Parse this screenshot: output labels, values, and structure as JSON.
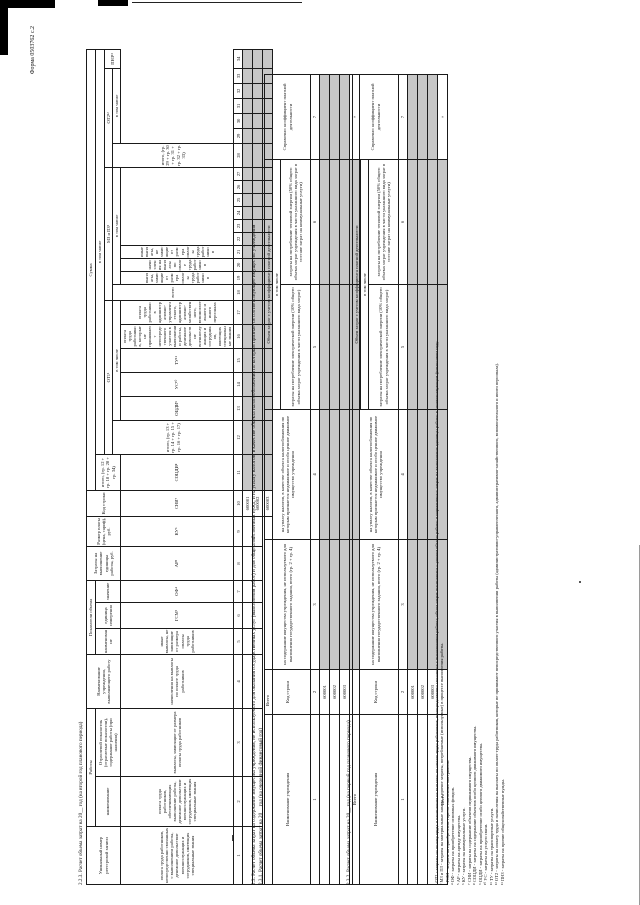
{
  "form_code": "Форма 0503762 с.2",
  "t1": {
    "title": "2.2.3. Расчет объема затрат на 20__ год (на второй год планового периода)",
    "works_group": "Работы",
    "vol_group": "Показатели объема",
    "sum_group": "Сумма",
    "incl": "в том числе",
    "c1": "Уникальный номер реестровой записи",
    "c2": "наименование",
    "c3": "Отраслевой показатель (отраслевые показатели), содержание работы (при наличии)",
    "c4": "Наименование учреждения, выполняющего работу",
    "c5": "наименование",
    "c6": "единица измерения",
    "c7": "значение",
    "c8": "Затраты на выполнение единицы работы, руб.",
    "c9": "Размер платы (цена, тариф), руб.",
    "c10": "Код строки",
    "c11": "итого, (гр. 12 + гр. 18 + гр. 28 + гр. 34)",
    "ot1_group": "ОТ1¹",
    "c12": "итого, (гр. 13 + гр. 14 + гр. 15 + гр. 16 + гр. 17)",
    "c13": "оплата труда работников, непосредственно связанных с выполнением работы, денежное довольствие военнослужащих и сотрудников, имеющих специальные звания",
    "c14": "оплата труда работников, обеспечивающих выполнение работы, денежное довольствие военнослужащих и сотрудников, имеющих специальные звания",
    "c15": "выплаты, зависящие от размера оплаты труда работников",
    "c16": "начисления на выплаты по оплате труда работников",
    "c17": "иные выплаты, не зависящие от размера оплаты труда работников",
    "mz_group": "МЗ и ПЗ²",
    "c18": "всего",
    "c19": "ГСМ³",
    "c20": "ОФ⁴",
    "c21": "АР⁵",
    "c22": "КУ⁶",
    "c23": "СНИ⁷",
    "c24": "СОЦДИ⁸",
    "c25": "ОЦДИ⁹",
    "c26": "УС¹⁰",
    "c27": "ТУ¹¹",
    "ot2_group": "ОТ2¹²",
    "c28": "итого, (гр. 29 + гр. 30 + гр. 31 + гр. 32 + гр. 33)",
    "c29": "оплата труда работников, которые не принимают непосредственного участия в выполнении работы, денежное довольствие военнослужащих и сотрудников, имеющих специальные звания",
    "c30": "оплата труда работников административно-управленческого, административно-хозяйственного, вспомогательного и иного персонала",
    "c31": "выплаты, зависящие от размера оплаты труда работников",
    "c32": "начисления на выплаты по оплате труда работников",
    "c33": "иные выплаты, не зависящие от размера оплаты труда работников",
    "c34": "ПНЗ¹³",
    "col_numbers": [
      "1",
      "2",
      "3",
      "4",
      "5",
      "6",
      "7",
      "8",
      "9",
      "10",
      "11",
      "12",
      "13",
      "14",
      "15",
      "16",
      "17",
      "18",
      "19",
      "20",
      "21",
      "22",
      "23",
      "24",
      "25",
      "26",
      "27",
      "28",
      "29",
      "30",
      "31",
      "32",
      "33",
      "34"
    ],
    "row1_code": "600001",
    "row2_code": "600002",
    "total_label": "Всего",
    "total_code": "600003"
  },
  "s23": {
    "title_a": "2.3. Расчет объема затрат на содержание имущества учреждения, не используемого для оказания государственных услуг (выполнения работ) и для общехозяйственных нужд, и на уплату налогов, в качестве объекта налогообложения по которым признается соответствующее имущество учреждения",
    "title_b": "2.3.1. Расчет объема затрат на 20__ год (на очередной финансовый год)",
    "title_c": "2.3.2. Расчет объема затрат на 20__ год (на первый год планового периода)"
  },
  "t23": {
    "c1": "Наименование учреждения",
    "c2": "Код строки",
    "c3": "на содержание имущества учреждения, не используемого для выполнения государственного задания, всего (гр. 2 + гр. 4)",
    "c4": "на уплату налогов, в качестве объекта налогообложения по которым признается недвижимое и особо ценное движимое имущество учреждения",
    "group": "Объем затрат с учетом коэффициента платной деятельности",
    "incl": "в том числе",
    "c5": "затраты на потребление электрической энергии (10% общего объема затрат учреждения в части указанного вида затрат)",
    "c6": "затраты на потребление тепловой энергии (50% общего объема затрат учреждения в части указанного вида затрат в составе затрат на коммунальные услуги)",
    "c7": "Справочно: коэффициент платной деятельности",
    "col_numbers": [
      "1",
      "2",
      "3",
      "4",
      "5",
      "6",
      "7"
    ],
    "row1_code": "600001",
    "row2_code": "600002",
    "row3_code": "600003",
    "total_label": "Всего",
    "total_mark": "×"
  },
  "footnotes": [
    "¹ ОТ1 - затраты на оплату труда и начисления на выплаты по оплате труда работников, непосредственно связанных с выполнением работы; объем затрат исчисляется с учетом объема работы и нормативных затрат на выполнение единицы работы в соответствующем финансовом году.",
    "² МЗ и ПЗ - затраты на материальные запасы и прочие затраты, потребляемые (используемые) в процессе выполнения работы.",
    "³ ГСМ - затраты на приобретение горюче-смазочных материалов.",
    "⁴ ОФ - затраты на приобретение основных фондов.",
    "⁵ АР - затраты на аренду имущества.",
    "⁶ КУ - затраты на коммунальные услуги.",
    "⁷ СНИ - затраты на содержание объектов недвижимого имущества.",
    "⁸ СОЦДИ - затраты на содержание объектов особо ценного движимого имущества.",
    "⁹ ОЦДИ - затраты на приобретение особо ценного движимого имущества.",
    "¹⁰ УС - затраты на услуги связи.",
    "¹¹ ТУ - затраты на транспортные услуги.",
    "¹² ОТ2 - затраты на оплату труда и начисления на выплаты по оплате труда работников, которые не принимают непосредственного участия в выполнении работы (административно-управленческого, административно-хозяйственного, вспомогательного и иного персонала).",
    "¹³ ПНЗ - затраты на прочие общехозяйственные нужды."
  ]
}
